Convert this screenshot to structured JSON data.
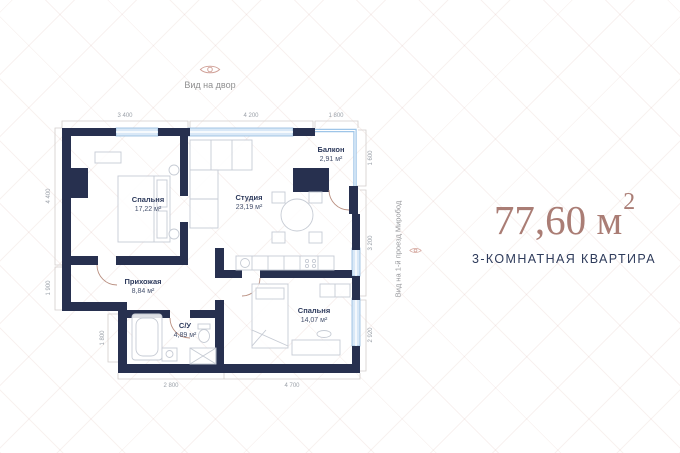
{
  "views": {
    "top_label": "Вид на двор",
    "right_label": "Вид на 1-й проезд Миробод"
  },
  "summary": {
    "area_value": "77,60 м",
    "area_superscript": "2",
    "apartment_type": "3-КОМНАТНАЯ КВАРТИРА"
  },
  "plan": {
    "rooms": [
      {
        "name": "Спальня",
        "area": "17,22 м²"
      },
      {
        "name": "Студия",
        "area": "23,19 м²"
      },
      {
        "name": "Балкон",
        "area": "2,91 м²"
      },
      {
        "name": "Прихожая",
        "area": "8,84 м²"
      },
      {
        "name": "С/У",
        "area": "4,89 м²"
      },
      {
        "name": "Спальня",
        "area": "14,07 м²"
      }
    ],
    "dimensions": {
      "top": [
        "3 400",
        "4 200",
        "1 800"
      ],
      "left": [
        "4 400",
        "1 900"
      ],
      "left_inner": [
        "1 800"
      ],
      "right": [
        "1 600",
        "3 200",
        "2 920"
      ],
      "bottom": [
        "2 800",
        "4 700"
      ]
    },
    "colors": {
      "wall": "#27304f",
      "window": "#9ec5e8",
      "door_arc": "#b98f80",
      "furniture_line": "#c6cbd4",
      "dimension_text": "#9aa0a8",
      "accent": "#aa7d75",
      "navy": "#2e3b5b"
    }
  }
}
